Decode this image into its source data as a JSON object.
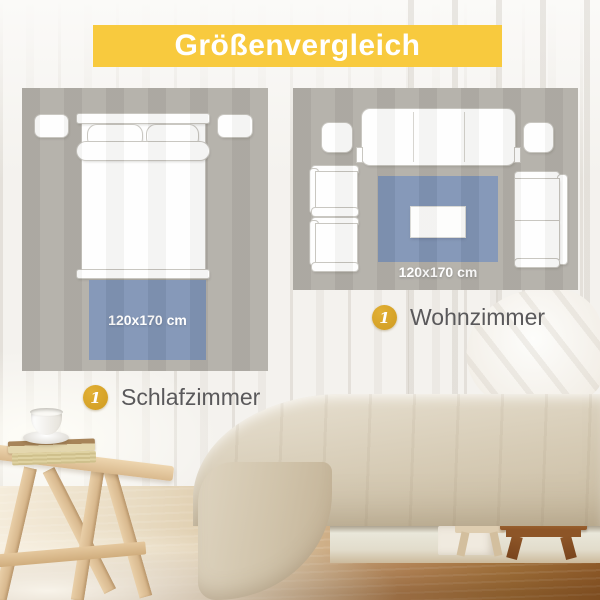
{
  "banner": {
    "title": "Größenvergleich"
  },
  "panels": {
    "bedroom": {
      "badge": "1",
      "label": "Schlafzimmer",
      "rug_label": "120x170 cm"
    },
    "livingroom": {
      "badge": "1",
      "label": "Wohnzimmer",
      "rug_label": "120x170 cm"
    }
  },
  "colors": {
    "banner_yellow": "#f8ca3e",
    "badge_yellow": "#d7a42a",
    "panel_gray": "#b2afa8",
    "rug_blue": "#8094b5",
    "label_text": "#5a595b",
    "rug_text": "#ffffff"
  }
}
